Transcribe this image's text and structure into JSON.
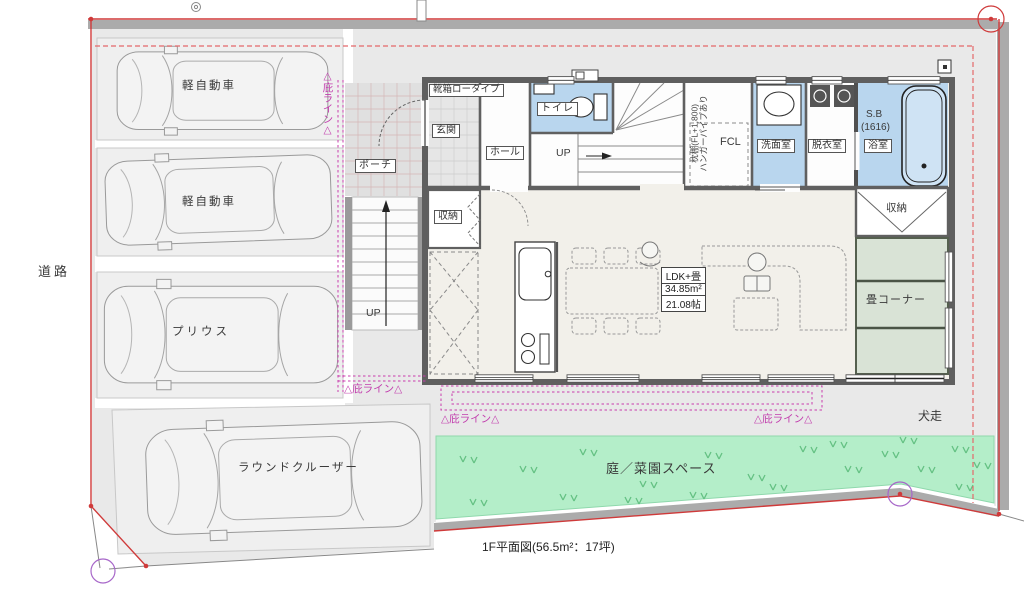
{
  "caption": "1F平面図(56.5m²：17坪)",
  "site": {
    "road": "道路",
    "dog_run": "犬走",
    "garden": "庭／菜園スペース",
    "eave_line": "△庇ライン△"
  },
  "parking": {
    "spaces": [
      {
        "label": "軽自動車"
      },
      {
        "label": "軽自動車"
      },
      {
        "label": "プリウス"
      },
      {
        "label": "ラウンドクルーザー"
      }
    ]
  },
  "entrance": {
    "porch": "ポーチ",
    "genkan": "玄関",
    "hall": "ホール",
    "shoebox": "靴箱ロータイプ"
  },
  "stairs": {
    "up": "UP"
  },
  "sanitary": {
    "toilet": "トイレ",
    "washroom": "洗面室",
    "dressing": "脱衣室",
    "bath": "浴室",
    "bath_sb": "S.B",
    "bath_size": "(1616)",
    "fcl": "FCL",
    "closet_shelf": "枕棚(FL+1,800)",
    "closet_pipe": "ハンガーパイプあり"
  },
  "living": {
    "ldk_title": "LDK+畳",
    "ldk_area_m2": "34.85m²",
    "ldk_area_jo": "21.08帖",
    "storage_left": "収納",
    "storage_right": "収納",
    "tatami": "畳コーナー"
  },
  "colors": {
    "wet_room_blue": "#b9d6ee",
    "tatami_green": "#d9e3d6",
    "garden_green": "#b4eec9",
    "boundary_red": "#cf3a3a",
    "eave_magenta": "#c93cad"
  }
}
